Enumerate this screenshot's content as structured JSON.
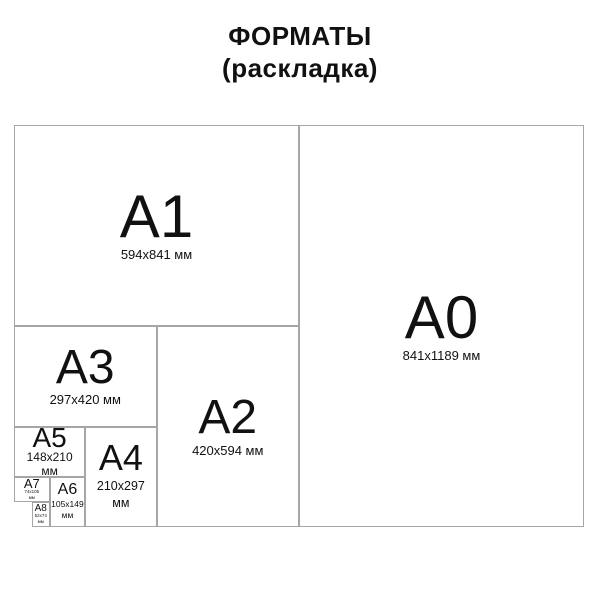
{
  "title": {
    "line1": "ФОРМАТЫ",
    "line2": "(раскладка)"
  },
  "diagram": {
    "description": "Nested paper format layout diagram",
    "unit_label": "мм",
    "panels": {
      "a0": {
        "label": "A0",
        "dims_line1": "841x1189 мм",
        "dims_line2": ""
      },
      "a1": {
        "label": "A1",
        "dims_line1": "594x841 мм",
        "dims_line2": ""
      },
      "a2": {
        "label": "A2",
        "dims_line1": "420x594 мм",
        "dims_line2": ""
      },
      "a3": {
        "label": "A3",
        "dims_line1": "297x420 мм",
        "dims_line2": ""
      },
      "a4": {
        "label": "A4",
        "dims_line1": "210x297",
        "dims_line2": "мм"
      },
      "a5": {
        "label": "A5",
        "dims_line1": "148x210",
        "dims_line2": "мм"
      },
      "a6": {
        "label": "A6",
        "dims_line1": "105x149",
        "dims_line2": "мм"
      },
      "a7": {
        "label": "A7",
        "dims_line1": "74x105",
        "dims_line2": "мм"
      },
      "a8": {
        "label": "A8",
        "dims_line1": "52x74",
        "dims_line2": "мм"
      }
    }
  },
  "colors": {
    "background": "#ffffff",
    "border": "#a6a6a6",
    "text": "#111111"
  }
}
